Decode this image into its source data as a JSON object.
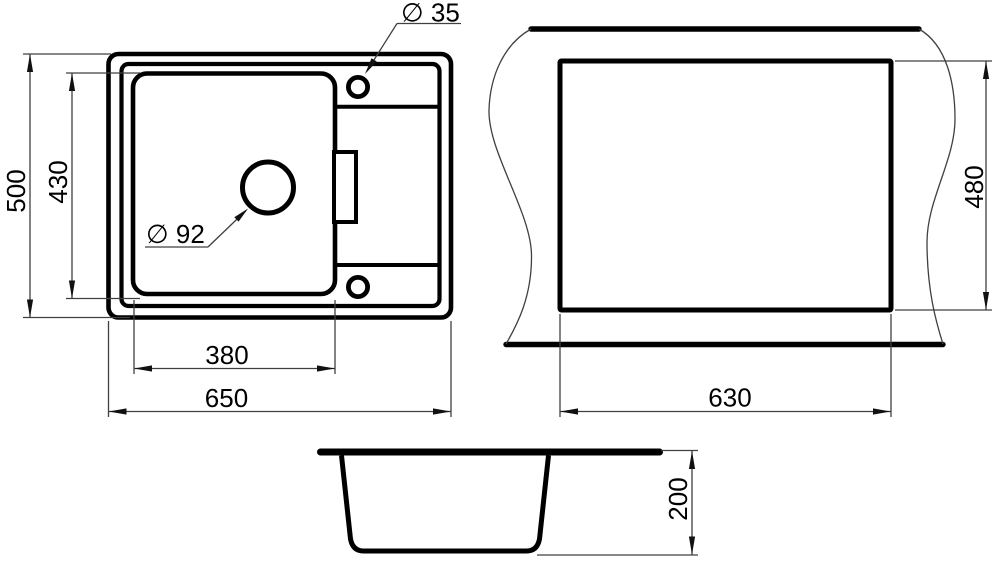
{
  "drawing": {
    "units": "mm",
    "colors": {
      "background": "#ffffff",
      "outline": "#000000",
      "dimension_lines": "#404040",
      "text": "#000000"
    },
    "top_view": {
      "overall_width": "650",
      "overall_depth": "500",
      "bowl_width": "380",
      "bowl_depth": "430",
      "tap_hole_diameter": "∅ 35",
      "drain_hole_diameter": "∅ 92"
    },
    "cutout_view": {
      "cutout_width": "630",
      "cutout_depth": "480"
    },
    "side_view": {
      "bowl_height": "200"
    }
  }
}
